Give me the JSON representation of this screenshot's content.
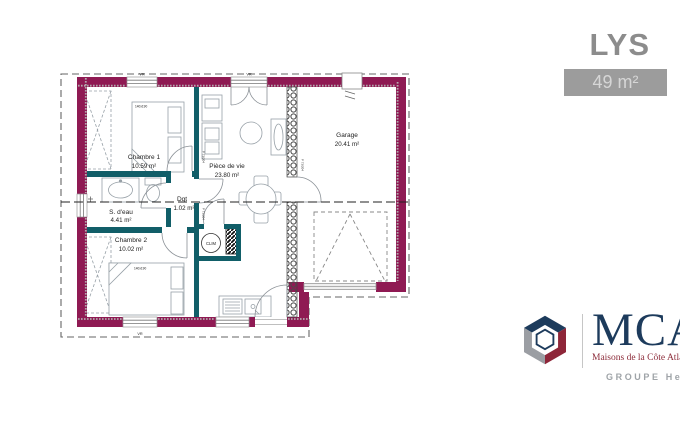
{
  "header": {
    "model_name": "LYS",
    "area_badge": "49 m²"
  },
  "plan": {
    "rooms": [
      {
        "name": "Chambre 1",
        "area": "10.59 m²"
      },
      {
        "name": "S. d'eau",
        "area": "4.41 m²"
      },
      {
        "name": "Chambre 2",
        "area": "10.02 m²"
      },
      {
        "name": "Dgt",
        "area": "1.02 m²"
      },
      {
        "name": "Pièce de vie",
        "area": "23.80 m²"
      },
      {
        "name": "Garage",
        "area": "20.41 m²"
      }
    ],
    "labels": {
      "clim": "CLIM",
      "bed_size": "140x190",
      "shutter": "VR",
      "door_size": "P 73/204"
    },
    "colors": {
      "exterior_wall": "#8F1A53",
      "partition": "#115E68"
    }
  },
  "brand": {
    "name": "MCA",
    "tagline": "Maisons de la Côte Atlantique",
    "group": "GROUPE Hexa",
    "colors": {
      "navy": "#1D3B5C",
      "red": "#8E2639",
      "gray": "#9B9EA3"
    }
  }
}
